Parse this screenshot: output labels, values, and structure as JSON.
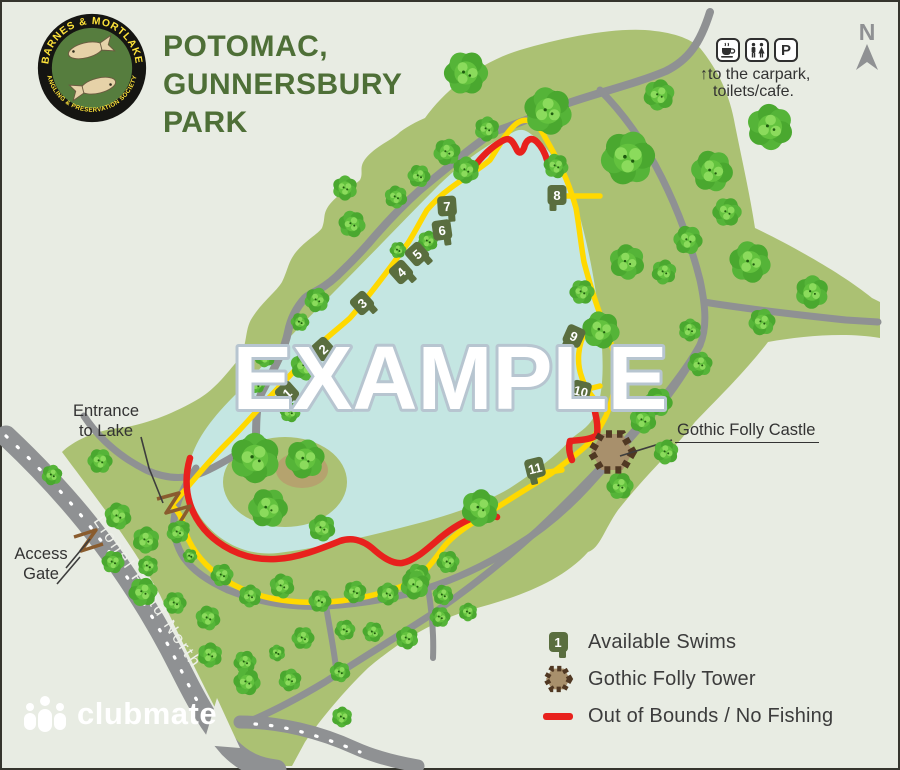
{
  "header": {
    "title_line1": "POTOMAC,",
    "title_line2": "GUNNERSBURY",
    "title_line3": "PARK",
    "logo": {
      "top_text": "BARNES & MORTLAKE",
      "bottom_text": "ANGLING & PRESERVATION SOCIETY"
    }
  },
  "facilities": {
    "parking_label": "P",
    "arrow": "↑",
    "note_line1": "to the carpark,",
    "note_line2": "toilets/cafe."
  },
  "compass": {
    "label": "N"
  },
  "map": {
    "watermark": "EXAMPLE",
    "road_label": "Lionel Road North",
    "labels": {
      "entrance_line1": "Entrance",
      "entrance_line2": "to Lake",
      "access_line1": "Access",
      "access_line2": "Gate",
      "folly": "Gothic Folly Castle"
    },
    "swims": [
      {
        "label": "1",
        "x": 287,
        "y": 393,
        "rot": -42,
        "flip": false
      },
      {
        "label": "2",
        "x": 323,
        "y": 349,
        "rot": -42,
        "flip": false
      },
      {
        "label": "3",
        "x": 362,
        "y": 303,
        "rot": -42,
        "flip": false
      },
      {
        "label": "4",
        "x": 401,
        "y": 272,
        "rot": -42,
        "flip": false
      },
      {
        "label": "5",
        "x": 417,
        "y": 254,
        "rot": -42,
        "flip": false
      },
      {
        "label": "6",
        "x": 442,
        "y": 230,
        "rot": -8,
        "flip": false
      },
      {
        "label": "7",
        "x": 447,
        "y": 206,
        "rot": -4,
        "flip": false
      },
      {
        "label": "8",
        "x": 557,
        "y": 195,
        "rot": 0,
        "flip": true
      },
      {
        "label": "9",
        "x": 574,
        "y": 336,
        "rot": 24,
        "flip": true
      },
      {
        "label": "10",
        "x": 581,
        "y": 391,
        "rot": 14,
        "flip": true
      },
      {
        "label": "11",
        "x": 535,
        "y": 468,
        "rot": -14,
        "flip": true
      }
    ]
  },
  "legend": {
    "swim_icon_label": "1",
    "items": [
      {
        "label": "Available Swims"
      },
      {
        "label": "Gothic Folly Tower"
      },
      {
        "label": "Out of Bounds / No Fishing"
      }
    ]
  },
  "brand": {
    "name": "clubmate"
  },
  "colors": {
    "background": "#e8ece3",
    "park_green": "#abc173",
    "lake_blue": "#c4e6e2",
    "road_gray": "#8f9193",
    "path_yellow": "#ffd900",
    "out_of_bounds_red": "#e8211d",
    "swim_marker_green": "#5a6e3f",
    "folly_fill": "#a8906c",
    "folly_wall": "#503823",
    "title_green": "#4e6f37"
  }
}
